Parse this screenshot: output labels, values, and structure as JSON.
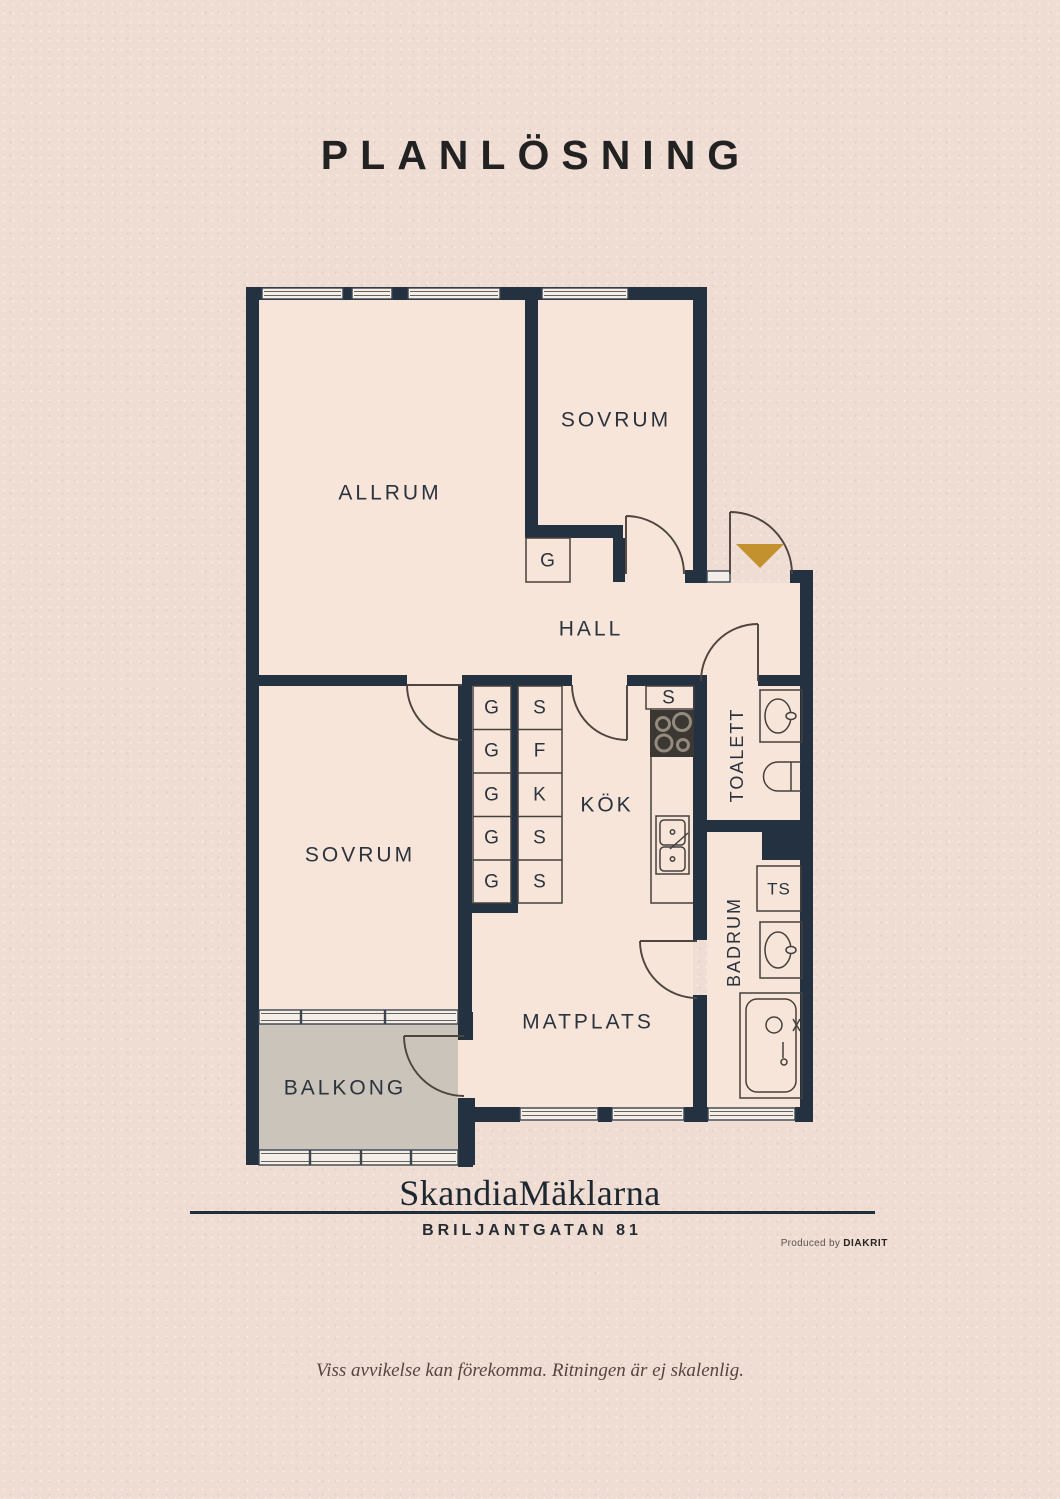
{
  "title": "PLANLÖSNING",
  "rooms": {
    "allrum": "ALLRUM",
    "sovrum_top": "SOVRUM",
    "hall": "HALL",
    "kok": "KÖK",
    "toalett": "TOALETT",
    "badrum": "BADRUM",
    "sovrum_bottom": "SOVRUM",
    "matplats": "MATPLATS",
    "balkong": "BALKONG"
  },
  "closets": {
    "hall": "G",
    "left": [
      "G",
      "G",
      "G",
      "G",
      "G"
    ],
    "right": [
      "S",
      "F",
      "K",
      "S",
      "S"
    ],
    "kitchen": "S",
    "ts": "TS"
  },
  "colors": {
    "background": "#efdcd2",
    "floor": "#f7e5d9",
    "wall": "#243140",
    "balcony": "#cac4bb",
    "window": "#f3efe8",
    "entrance_marker": "#c3922e",
    "label": "#2b333e"
  },
  "branding": {
    "logo": "SkandiaMäklarna",
    "address": "BRILJANTGATAN 81",
    "produced_prefix": "Produced by",
    "produced_brand": "DIAKRIT"
  },
  "footer": {
    "disclaimer": "Viss avvikelse kan förekomma. Ritningen är ej skalenlig."
  }
}
